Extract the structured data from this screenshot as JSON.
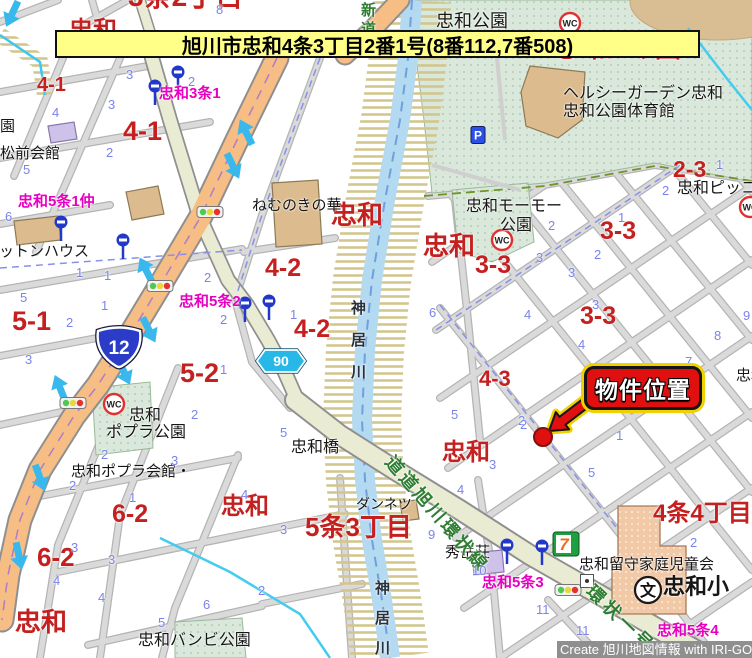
{
  "title_banner": {
    "text": "旭川市忠和4条3丁目2番1号(8番112,7番508)"
  },
  "watermark": {
    "text": "Create 旭川地図情報 with IRI-GO"
  },
  "callout": {
    "label": "物件位置"
  },
  "route_shields": {
    "national": {
      "number": "12"
    },
    "prefectural": {
      "number": "90"
    }
  },
  "icon_labels": {
    "wc": "WC",
    "parking": "P",
    "school": "文",
    "store": "7"
  },
  "labels": {
    "districts": [
      {
        "t": "忠和",
        "x": 331,
        "y": 202,
        "s": 26
      },
      {
        "t": "忠和",
        "x": 423,
        "y": 233,
        "s": 26
      },
      {
        "t": "忠和",
        "x": 442,
        "y": 441,
        "s": 24
      },
      {
        "t": "忠和",
        "x": 221,
        "y": 495,
        "s": 24
      },
      {
        "t": "忠和",
        "x": 15,
        "y": 609,
        "s": 26
      }
    ],
    "partials": [
      {
        "t": "忠和",
        "x": 69,
        "y": 19,
        "s": 24
      },
      {
        "t": "3条2丁目",
        "x": 128,
        "y": -17,
        "s": 28
      },
      {
        "t": "忠和公園",
        "x": 553,
        "y": 35,
        "s": 26,
        "ls": 8
      }
    ],
    "blocks": [
      {
        "t": "4-1",
        "x": 37,
        "y": 75,
        "s": 20
      },
      {
        "t": "4-1",
        "x": 123,
        "y": 118,
        "s": 27
      },
      {
        "t": "4-2",
        "x": 265,
        "y": 256,
        "s": 25
      },
      {
        "t": "4-2",
        "x": 294,
        "y": 317,
        "s": 25
      },
      {
        "t": "5-1",
        "x": 12,
        "y": 308,
        "s": 27
      },
      {
        "t": "5-2",
        "x": 180,
        "y": 360,
        "s": 27
      },
      {
        "t": "3-3",
        "x": 475,
        "y": 253,
        "s": 25
      },
      {
        "t": "3-3",
        "x": 600,
        "y": 219,
        "s": 25
      },
      {
        "t": "3-3",
        "x": 580,
        "y": 304,
        "s": 25
      },
      {
        "t": "2-3",
        "x": 673,
        "y": 158,
        "s": 23
      },
      {
        "t": "4-3",
        "x": 479,
        "y": 368,
        "s": 22
      },
      {
        "t": "6-2",
        "x": 112,
        "y": 502,
        "s": 25
      },
      {
        "t": "6-2",
        "x": 37,
        "y": 544,
        "s": 26
      },
      {
        "t": "5条3丁目",
        "x": 305,
        "y": 514,
        "s": 26
      },
      {
        "t": "4条4丁目",
        "x": 653,
        "y": 502,
        "s": 24
      }
    ],
    "bus_stops": [
      {
        "t": "忠和3条1",
        "x": 159,
        "y": 86,
        "s": 15
      },
      {
        "t": "忠和5条1仲",
        "x": 18,
        "y": 194,
        "s": 15
      },
      {
        "t": "忠和5条2",
        "x": 179,
        "y": 294,
        "s": 15
      },
      {
        "t": "忠和5条3",
        "x": 482,
        "y": 575,
        "s": 15
      },
      {
        "t": "忠和5条4",
        "x": 657,
        "y": 623,
        "s": 15
      }
    ],
    "facilities": [
      {
        "t": "忠和公園",
        "x": 436,
        "y": 12,
        "s": 18
      },
      {
        "t": "ヘルシーガーデン忠和",
        "x": 563,
        "y": 86,
        "s": 16
      },
      {
        "t": "忠和公園体育館",
        "x": 563,
        "y": 104,
        "s": 16
      },
      {
        "t": "園",
        "x": 0,
        "y": 119,
        "s": 15
      },
      {
        "t": "松前会館",
        "x": 0,
        "y": 146,
        "s": 15
      },
      {
        "t": "コットンハウス",
        "x": -16,
        "y": 244,
        "s": 15
      },
      {
        "t": "ねむのきの華",
        "x": 252,
        "y": 198,
        "s": 15
      },
      {
        "t": "忠和モーモー",
        "x": 466,
        "y": 199,
        "s": 16
      },
      {
        "t": "公園",
        "x": 500,
        "y": 218,
        "s": 16
      },
      {
        "t": "忠和ピッコロ",
        "x": 677,
        "y": 181,
        "s": 16
      },
      {
        "t": "忠和",
        "x": 129,
        "y": 408,
        "s": 16
      },
      {
        "t": "ポプラ公園",
        "x": 106,
        "y": 425,
        "s": 16
      },
      {
        "t": "忠和ポプラ会館・",
        "x": 71,
        "y": 464,
        "s": 15
      },
      {
        "t": "忠和橋",
        "x": 291,
        "y": 440,
        "s": 16
      },
      {
        "t": "ダンネツ",
        "x": 356,
        "y": 497,
        "s": 14
      },
      {
        "t": "秀岳荘",
        "x": 445,
        "y": 545,
        "s": 15
      },
      {
        "t": "忠和留守家庭児童会",
        "x": 579,
        "y": 557,
        "s": 15
      },
      {
        "t": "忠和小",
        "x": 663,
        "y": 576,
        "s": 22,
        "bold": true
      },
      {
        "t": "忠和バンビ公園",
        "x": 138,
        "y": 633,
        "s": 16
      },
      {
        "t": "忠和",
        "x": 736,
        "y": 368,
        "s": 15
      }
    ],
    "rivers": [
      {
        "t": "神居川",
        "x": 350,
        "y": 300,
        "s": 15,
        "vert": true,
        "ls": 17
      },
      {
        "t": "神居川",
        "x": 374,
        "y": 580,
        "s": 15,
        "vert": true,
        "ls": 15
      }
    ],
    "roads": [
      {
        "t": "新道",
        "x": 360,
        "y": 2,
        "s": 15,
        "vert": true,
        "ls": 4
      },
      {
        "t": "道道旭川環状線",
        "x": 437,
        "y": 514,
        "s": 18,
        "rot": 49,
        "ls": 3
      },
      {
        "t": "環状一号",
        "x": 621,
        "y": 619,
        "s": 18,
        "rot": 44,
        "ls": 4
      }
    ],
    "lot_numbers": [
      [
        126,
        68,
        "3"
      ],
      [
        188,
        75,
        "2"
      ],
      [
        108,
        98,
        "3"
      ],
      [
        52,
        106,
        "4"
      ],
      [
        106,
        146,
        "2"
      ],
      [
        23,
        163,
        "5"
      ],
      [
        5,
        210,
        "6"
      ],
      [
        216,
        3,
        "8"
      ],
      [
        76,
        266,
        "1"
      ],
      [
        104,
        269,
        "1"
      ],
      [
        20,
        291,
        "5"
      ],
      [
        101,
        299,
        "1"
      ],
      [
        66,
        316,
        "2"
      ],
      [
        204,
        271,
        "2"
      ],
      [
        220,
        313,
        "2"
      ],
      [
        25,
        353,
        "3"
      ],
      [
        220,
        363,
        "1"
      ],
      [
        191,
        408,
        "2"
      ],
      [
        290,
        308,
        "1"
      ],
      [
        429,
        306,
        "6"
      ],
      [
        662,
        184,
        "2"
      ],
      [
        716,
        158,
        "1"
      ],
      [
        618,
        211,
        "1"
      ],
      [
        548,
        219,
        "2"
      ],
      [
        594,
        248,
        "2"
      ],
      [
        536,
        251,
        "3"
      ],
      [
        568,
        266,
        "3"
      ],
      [
        524,
        308,
        "4"
      ],
      [
        592,
        298,
        "3"
      ],
      [
        743,
        309,
        "9"
      ],
      [
        714,
        329,
        "8"
      ],
      [
        685,
        355,
        "7"
      ],
      [
        668,
        401,
        "6"
      ],
      [
        578,
        338,
        "4"
      ],
      [
        586,
        384,
        "1"
      ],
      [
        518,
        414,
        "2"
      ],
      [
        616,
        429,
        "1"
      ],
      [
        588,
        466,
        "5"
      ],
      [
        101,
        448,
        "2"
      ],
      [
        171,
        454,
        "3"
      ],
      [
        69,
        479,
        "2"
      ],
      [
        129,
        491,
        "1"
      ],
      [
        241,
        488,
        "4"
      ],
      [
        71,
        541,
        "3"
      ],
      [
        108,
        553,
        "3"
      ],
      [
        280,
        426,
        "5"
      ],
      [
        451,
        408,
        "5"
      ],
      [
        520,
        418,
        "2"
      ],
      [
        489,
        458,
        "3"
      ],
      [
        457,
        483,
        "4"
      ],
      [
        280,
        523,
        "3"
      ],
      [
        428,
        528,
        "9"
      ],
      [
        472,
        564,
        "10"
      ],
      [
        536,
        603,
        "11"
      ],
      [
        576,
        624,
        "11"
      ],
      [
        690,
        536,
        "2"
      ],
      [
        53,
        574,
        "4"
      ],
      [
        98,
        591,
        "4"
      ],
      [
        258,
        584,
        "2"
      ],
      [
        203,
        598,
        "6"
      ],
      [
        158,
        616,
        "5"
      ]
    ]
  },
  "icons": [
    {
      "t": "bus",
      "x": 155,
      "y": 86
    },
    {
      "t": "bus",
      "x": 178,
      "y": 72
    },
    {
      "t": "bus",
      "x": 61,
      "y": 222
    },
    {
      "t": "bus",
      "x": 123,
      "y": 240
    },
    {
      "t": "bus",
      "x": 245,
      "y": 303
    },
    {
      "t": "bus",
      "x": 269,
      "y": 301
    },
    {
      "t": "bus",
      "x": 507,
      "y": 545
    },
    {
      "t": "bus",
      "x": 542,
      "y": 546
    },
    {
      "t": "wc",
      "x": 570,
      "y": 23
    },
    {
      "t": "wc",
      "x": 502,
      "y": 240
    },
    {
      "t": "wc",
      "x": 114,
      "y": 404
    },
    {
      "t": "wc",
      "x": 750,
      "y": 207
    },
    {
      "t": "traffic",
      "x": 210,
      "y": 212
    },
    {
      "t": "traffic",
      "x": 160,
      "y": 286
    },
    {
      "t": "traffic",
      "x": 73,
      "y": 403
    },
    {
      "t": "traffic",
      "x": 568,
      "y": 590
    },
    {
      "t": "parking",
      "x": 478,
      "y": 135
    },
    {
      "t": "store",
      "x": 566,
      "y": 544
    },
    {
      "t": "school",
      "x": 648,
      "y": 590
    },
    {
      "t": "building-dot",
      "x": 587,
      "y": 581
    }
  ],
  "colors": {
    "block_red": "#c52020",
    "busstop_magenta": "#e800c0",
    "lot_blue": "#7b84e8",
    "road_green": "#2e7d32",
    "banner_bg": "#ffff88",
    "callout_red": "#e01010",
    "callout_outline_yellow": "#f0d000",
    "route12_blue": "#2a3cc8",
    "route90_cyan": "#28b8e8"
  }
}
